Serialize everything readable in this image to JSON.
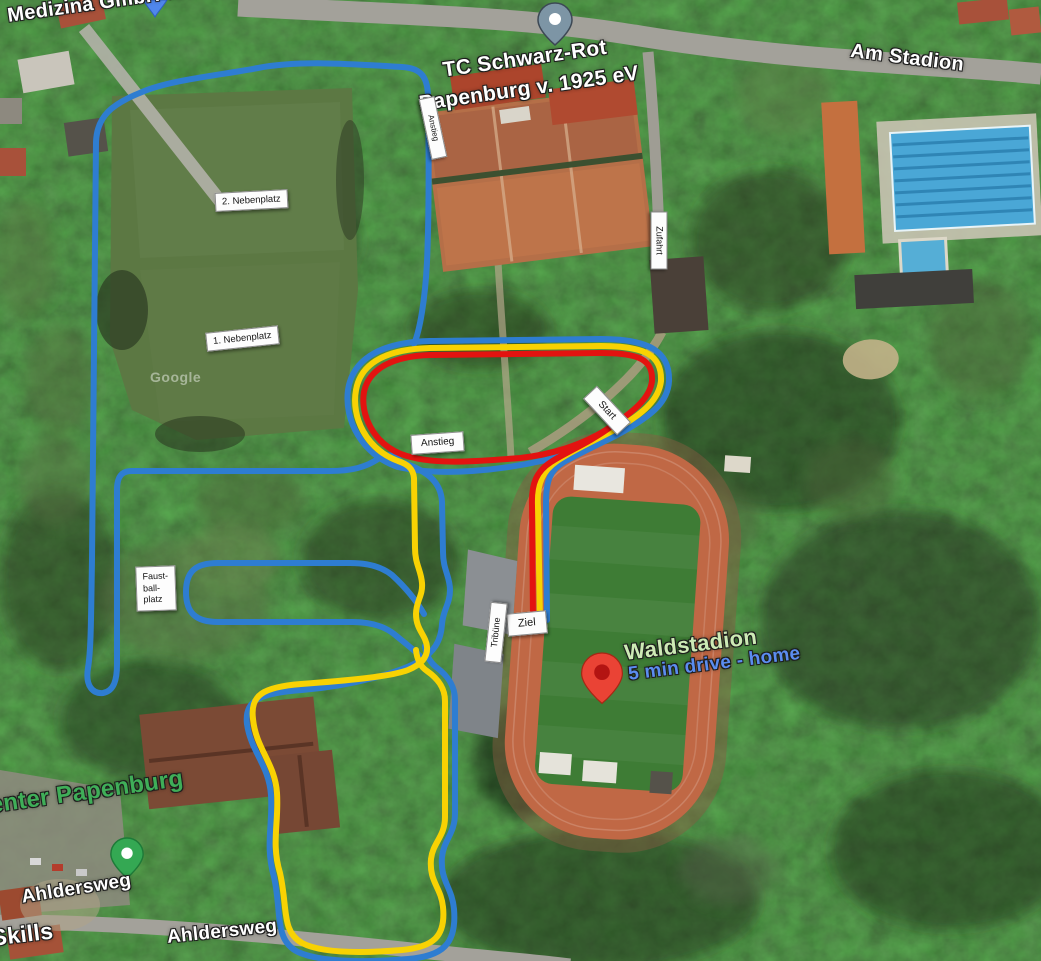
{
  "map_labels": {
    "medizina": "Medizina GmbH & Co.",
    "tennis_club_line1": "TC Schwarz-Rot",
    "tennis_club_line2": "Papenburg v. 1925 eV",
    "am_stadion": "Am Stadion",
    "ahldersweg_1": "Ahldersweg",
    "ahldersweg_2": "Ahldersweg",
    "skills_partial": "Skills",
    "center_partial": "enter Papenburg",
    "waldstadion": "Waldstadion",
    "drive_note": "5 min drive - home",
    "google_watermark": "Google"
  },
  "course_labels": {
    "nebenplatz_2": "2. Nebenplatz",
    "nebenplatz_1": "1. Nebenplatz",
    "anstieg_path": "Anstieg",
    "anstieg_hill": "Anstieg",
    "zufahrt": "Zufahrt",
    "start": "Start",
    "ziel": "Ziel",
    "tribuene": "Tribüne",
    "faustballplatz_line1": "Faust-",
    "faustballplatz_line2": "ball-",
    "faustballplatz_line3": "platz"
  },
  "routes": {
    "long_course_color": "#2e7dd1",
    "medium_course_color": "#f8d203",
    "short_course_color": "#e31310"
  },
  "pins": {
    "destination_pin_color": "#ea4335",
    "destination_pin_inner": "#b31412",
    "green_pin_color": "#34a853",
    "gray_pin_color": "#7d95a5",
    "blue_pin_color": "#5087ec"
  },
  "label_colors": {
    "park_label_green": "#cdeab5",
    "route_note_blue": "#5b8df0",
    "business_green": "#3fae58"
  }
}
